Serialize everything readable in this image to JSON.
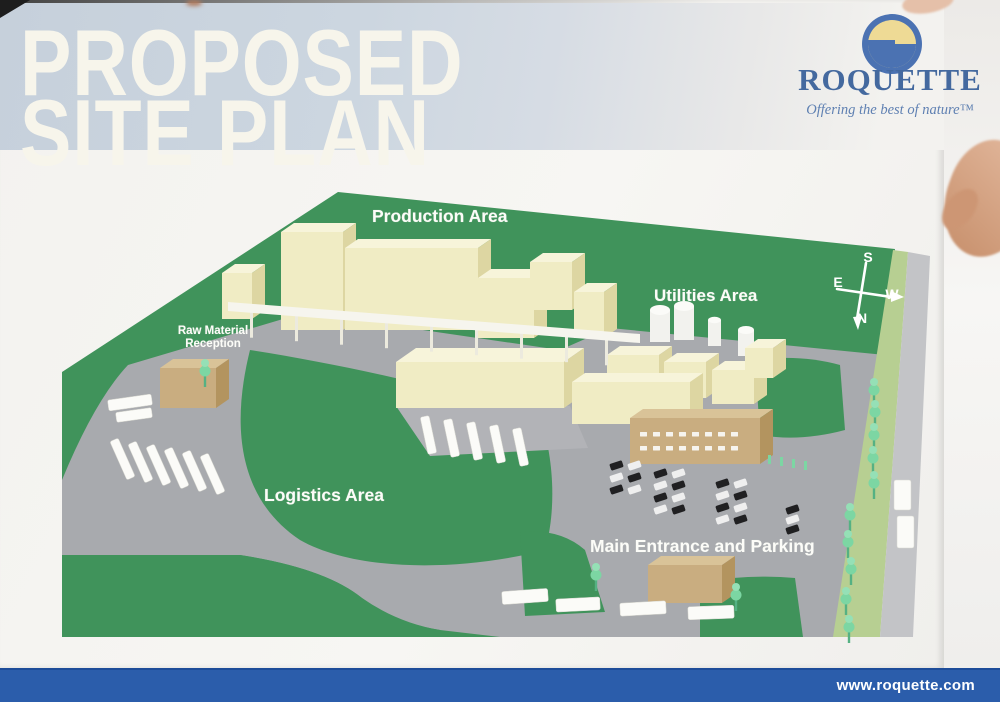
{
  "header": {
    "title_line1": "PROPOSED",
    "title_line2": "SITE PLAN"
  },
  "logo": {
    "brand": "ROQUETTE",
    "tagline": "Offering the best of nature™",
    "mark": "roquette-e-circle"
  },
  "site_plan": {
    "labels": {
      "production": "Production Area",
      "utilities": "Utilities Area",
      "raw_material_line1": "Raw Material",
      "raw_material_line2": "Reception",
      "logistics": "Logistics Area",
      "main_entrance": "Main Entrance and Parking"
    },
    "compass": {
      "top": "S",
      "left": "E",
      "right": "W",
      "bottom": "N"
    }
  },
  "footer": {
    "website": "www.roquette.com"
  },
  "colors": {
    "field_green": "#40935b",
    "road_gray": "#a8aaae",
    "verge_green": "#b7cf92",
    "tree_green": "#7cd6a3",
    "building_cream": "#f0ecc4",
    "building_tan": "#c9ad80",
    "header_band": "#ccd6e0",
    "title_white": "#f7f5eb",
    "brand_blue": "#4b72b2",
    "brand_text": "#44699f",
    "footer_blue": "#2b5dab"
  }
}
